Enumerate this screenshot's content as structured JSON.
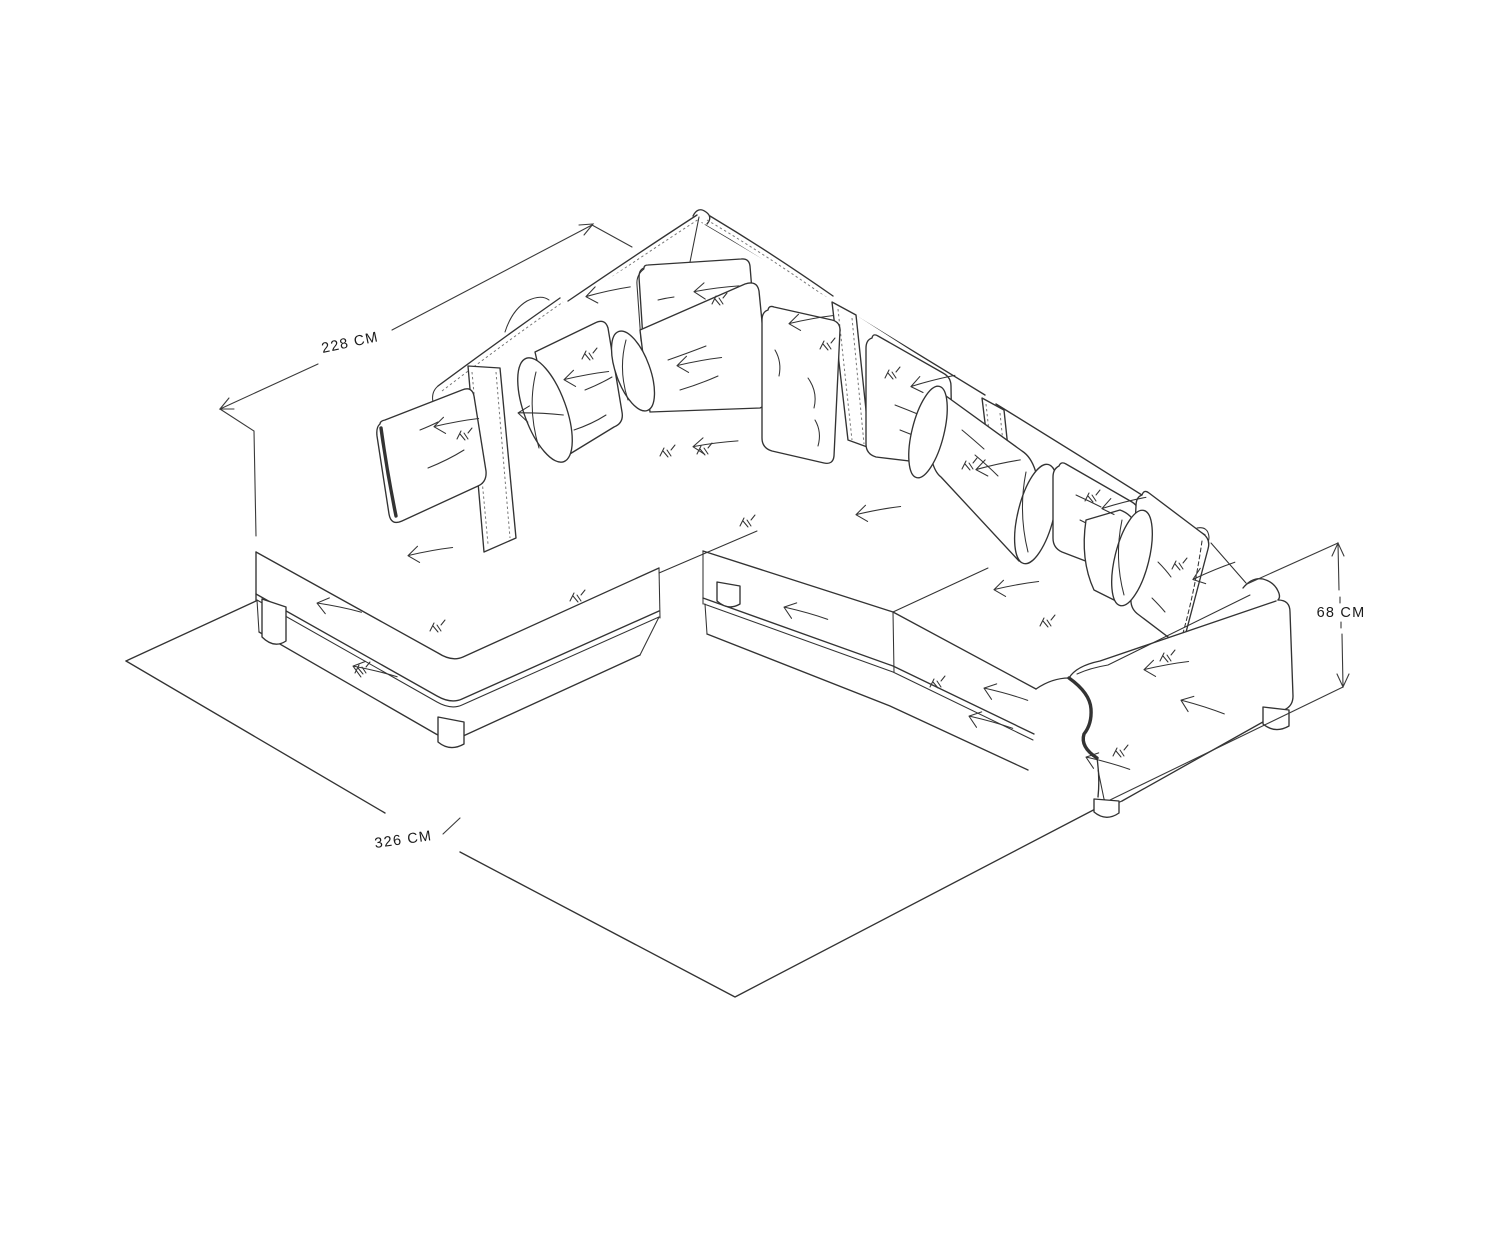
{
  "drawing": {
    "dimensions": {
      "back_width": "228 CM",
      "front_width": "326 CM",
      "height": "68 CM"
    },
    "colors": {
      "background": "#ffffff",
      "line": "#333333",
      "label": "#1b1b1b"
    }
  }
}
